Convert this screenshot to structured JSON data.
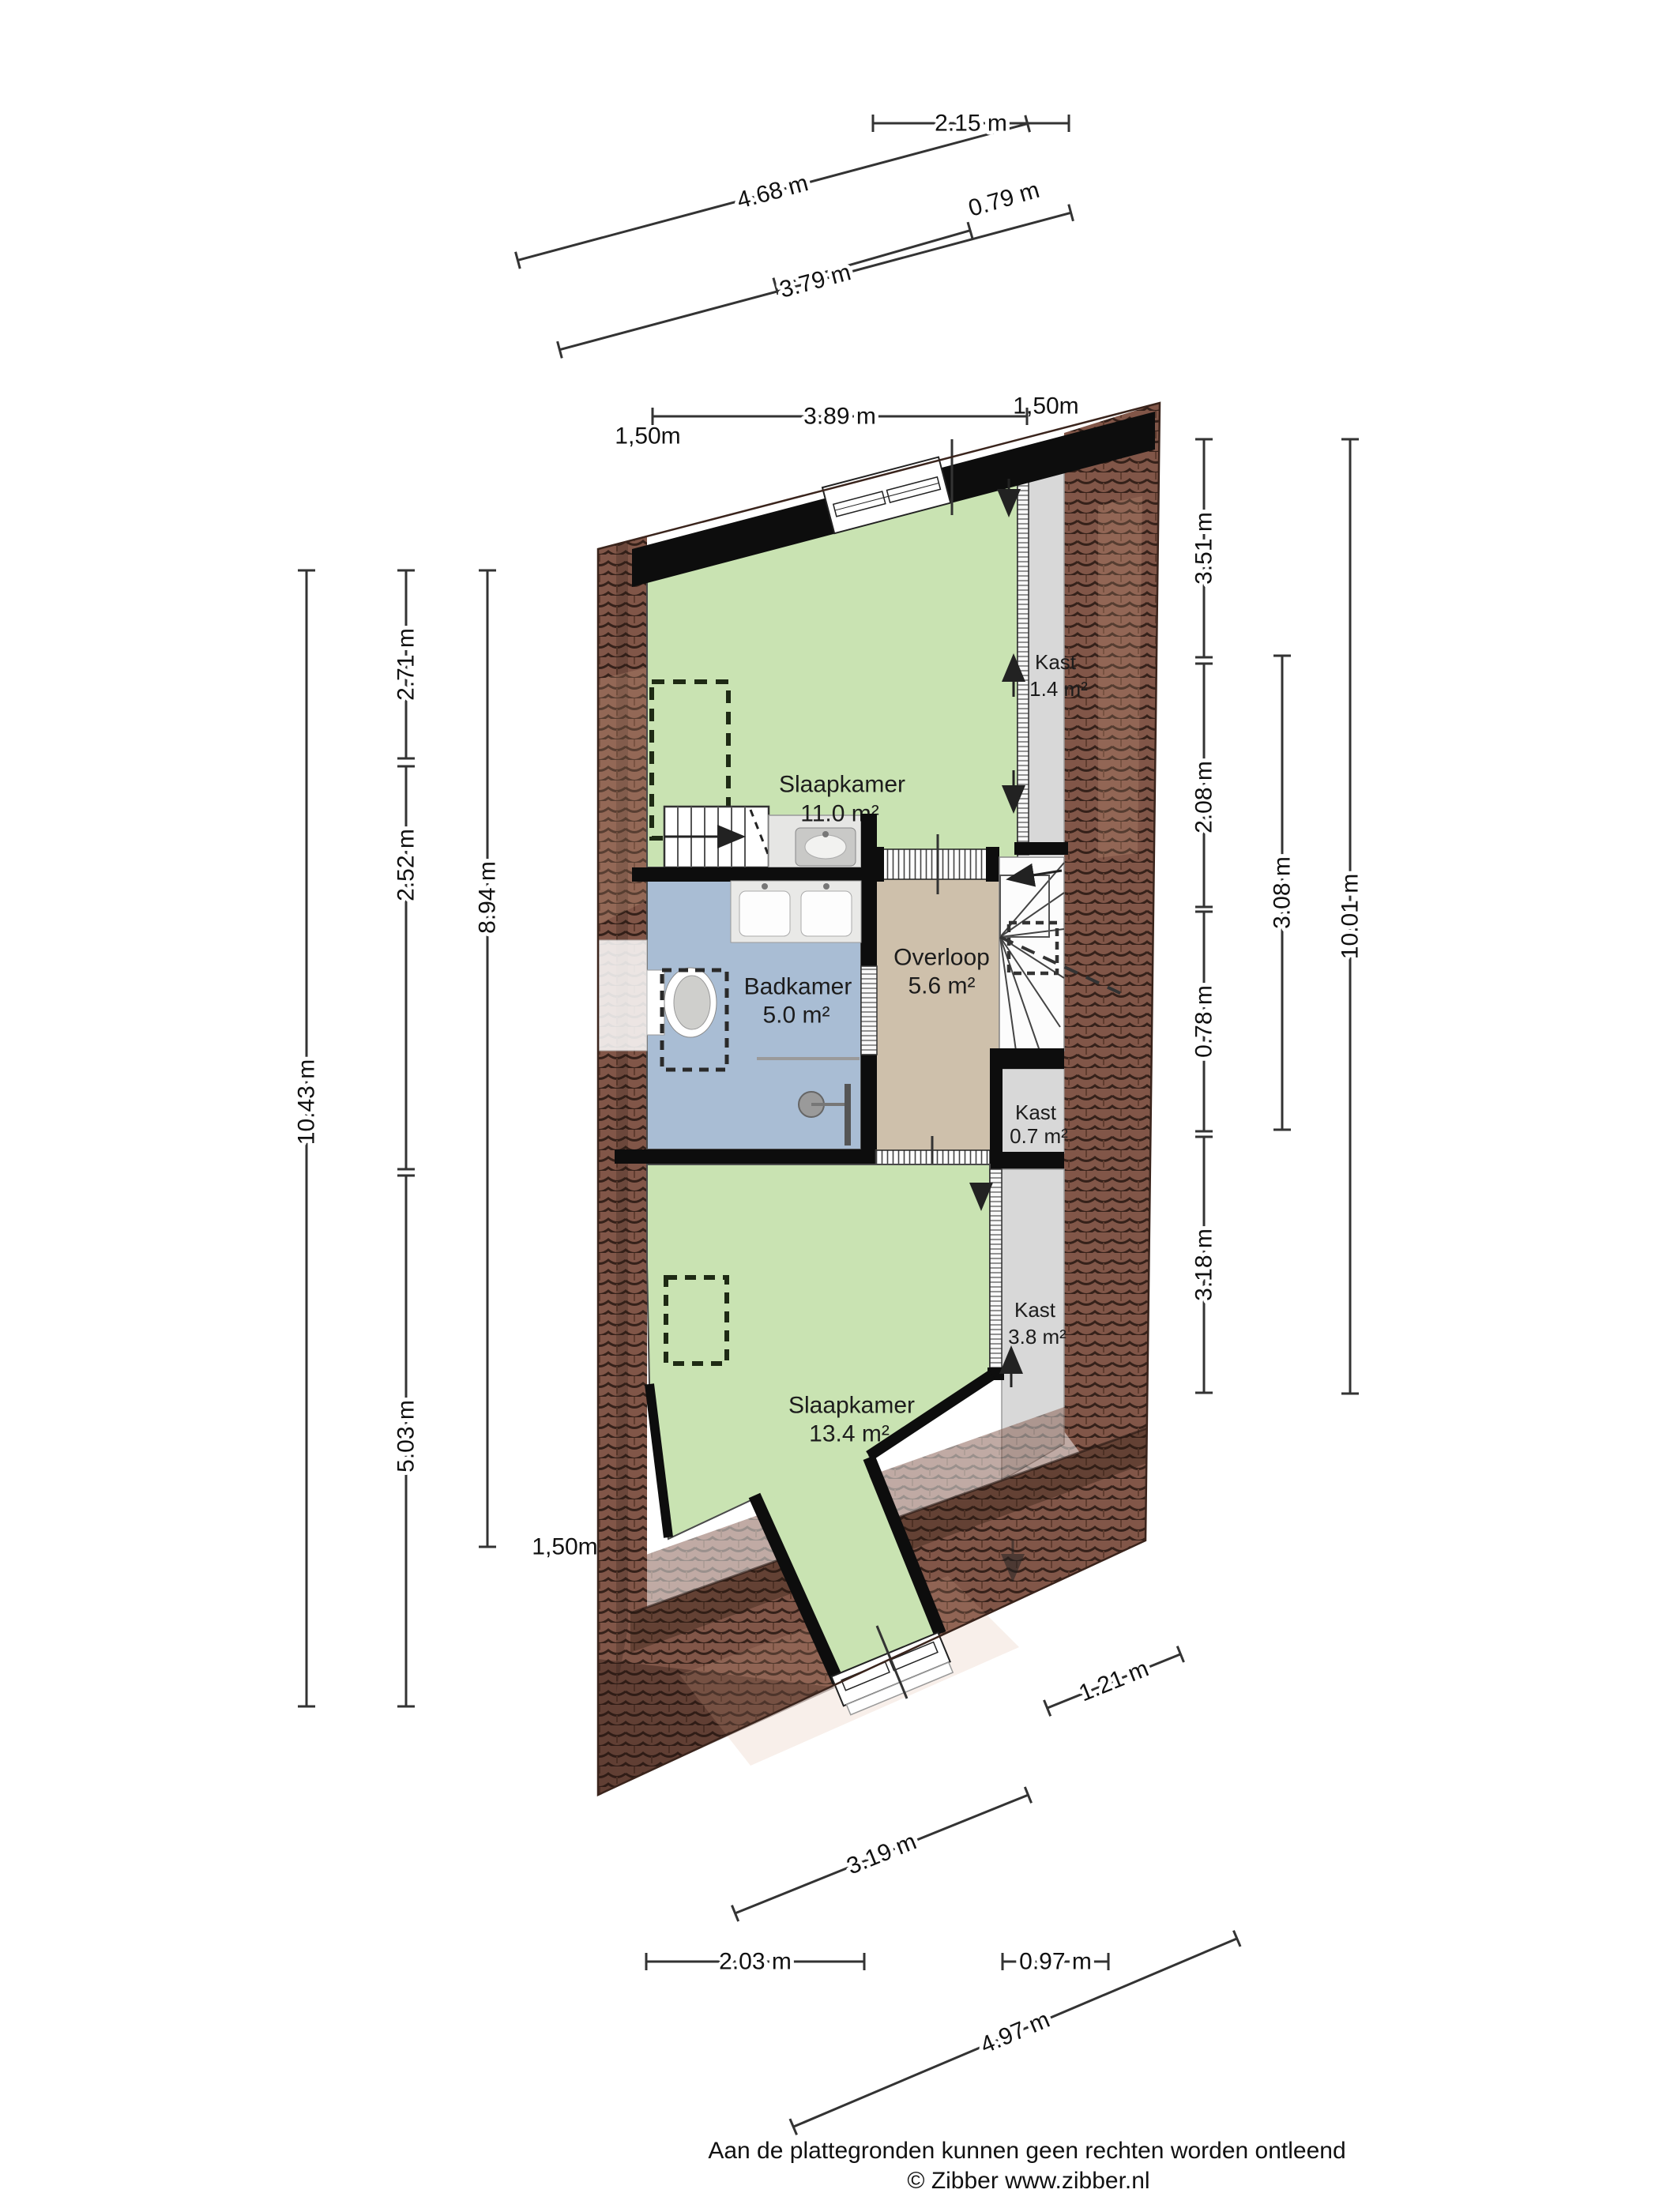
{
  "rooms": {
    "slaapkamer1": {
      "name": "Slaapkamer",
      "area": "11.0 m²"
    },
    "kast1": {
      "name": "Kast",
      "area": "1.4 m²"
    },
    "badkamer": {
      "name": "Badkamer",
      "area": "5.0 m²"
    },
    "overloop": {
      "name": "Overloop",
      "area": "5.6 m²"
    },
    "kast2": {
      "name": "Kast",
      "area": "0.7 m²"
    },
    "slaapkamer2": {
      "name": "Slaapkamer",
      "area": "13.4 m²"
    },
    "kast3": {
      "name": "Kast",
      "area": "3.8 m²"
    }
  },
  "dims": {
    "top": [
      "4.68 m",
      "2.15 m",
      "0.79 m",
      "3.79 m",
      "3.89 m"
    ],
    "left": [
      "2.71 m",
      "2.52 m",
      "5.03 m",
      "10.43 m",
      "8.94 m"
    ],
    "right": [
      "3.51 m",
      "2.08 m",
      "0.78 m",
      "3.18 m",
      "3.08 m",
      "10.01 m"
    ],
    "bottom": [
      "1.21 m",
      "3.19 m",
      "2.03 m",
      "0.97 m",
      "4.97 m"
    ],
    "height_marks": [
      "1,50m",
      "1,50m",
      "1,50m"
    ]
  },
  "footer": {
    "line1": "Aan de plattegronden kunnen geen rechten worden ontleend",
    "line2": "© Zibber www.zibber.nl"
  },
  "colors": {
    "room_green": "#c9e3b2",
    "room_blue": "#a9bdd4",
    "room_tan": "#cec0ab",
    "room_gray": "#d8d8d8",
    "roof_tile": "#815648",
    "wall_black": "#0d0d0d"
  }
}
